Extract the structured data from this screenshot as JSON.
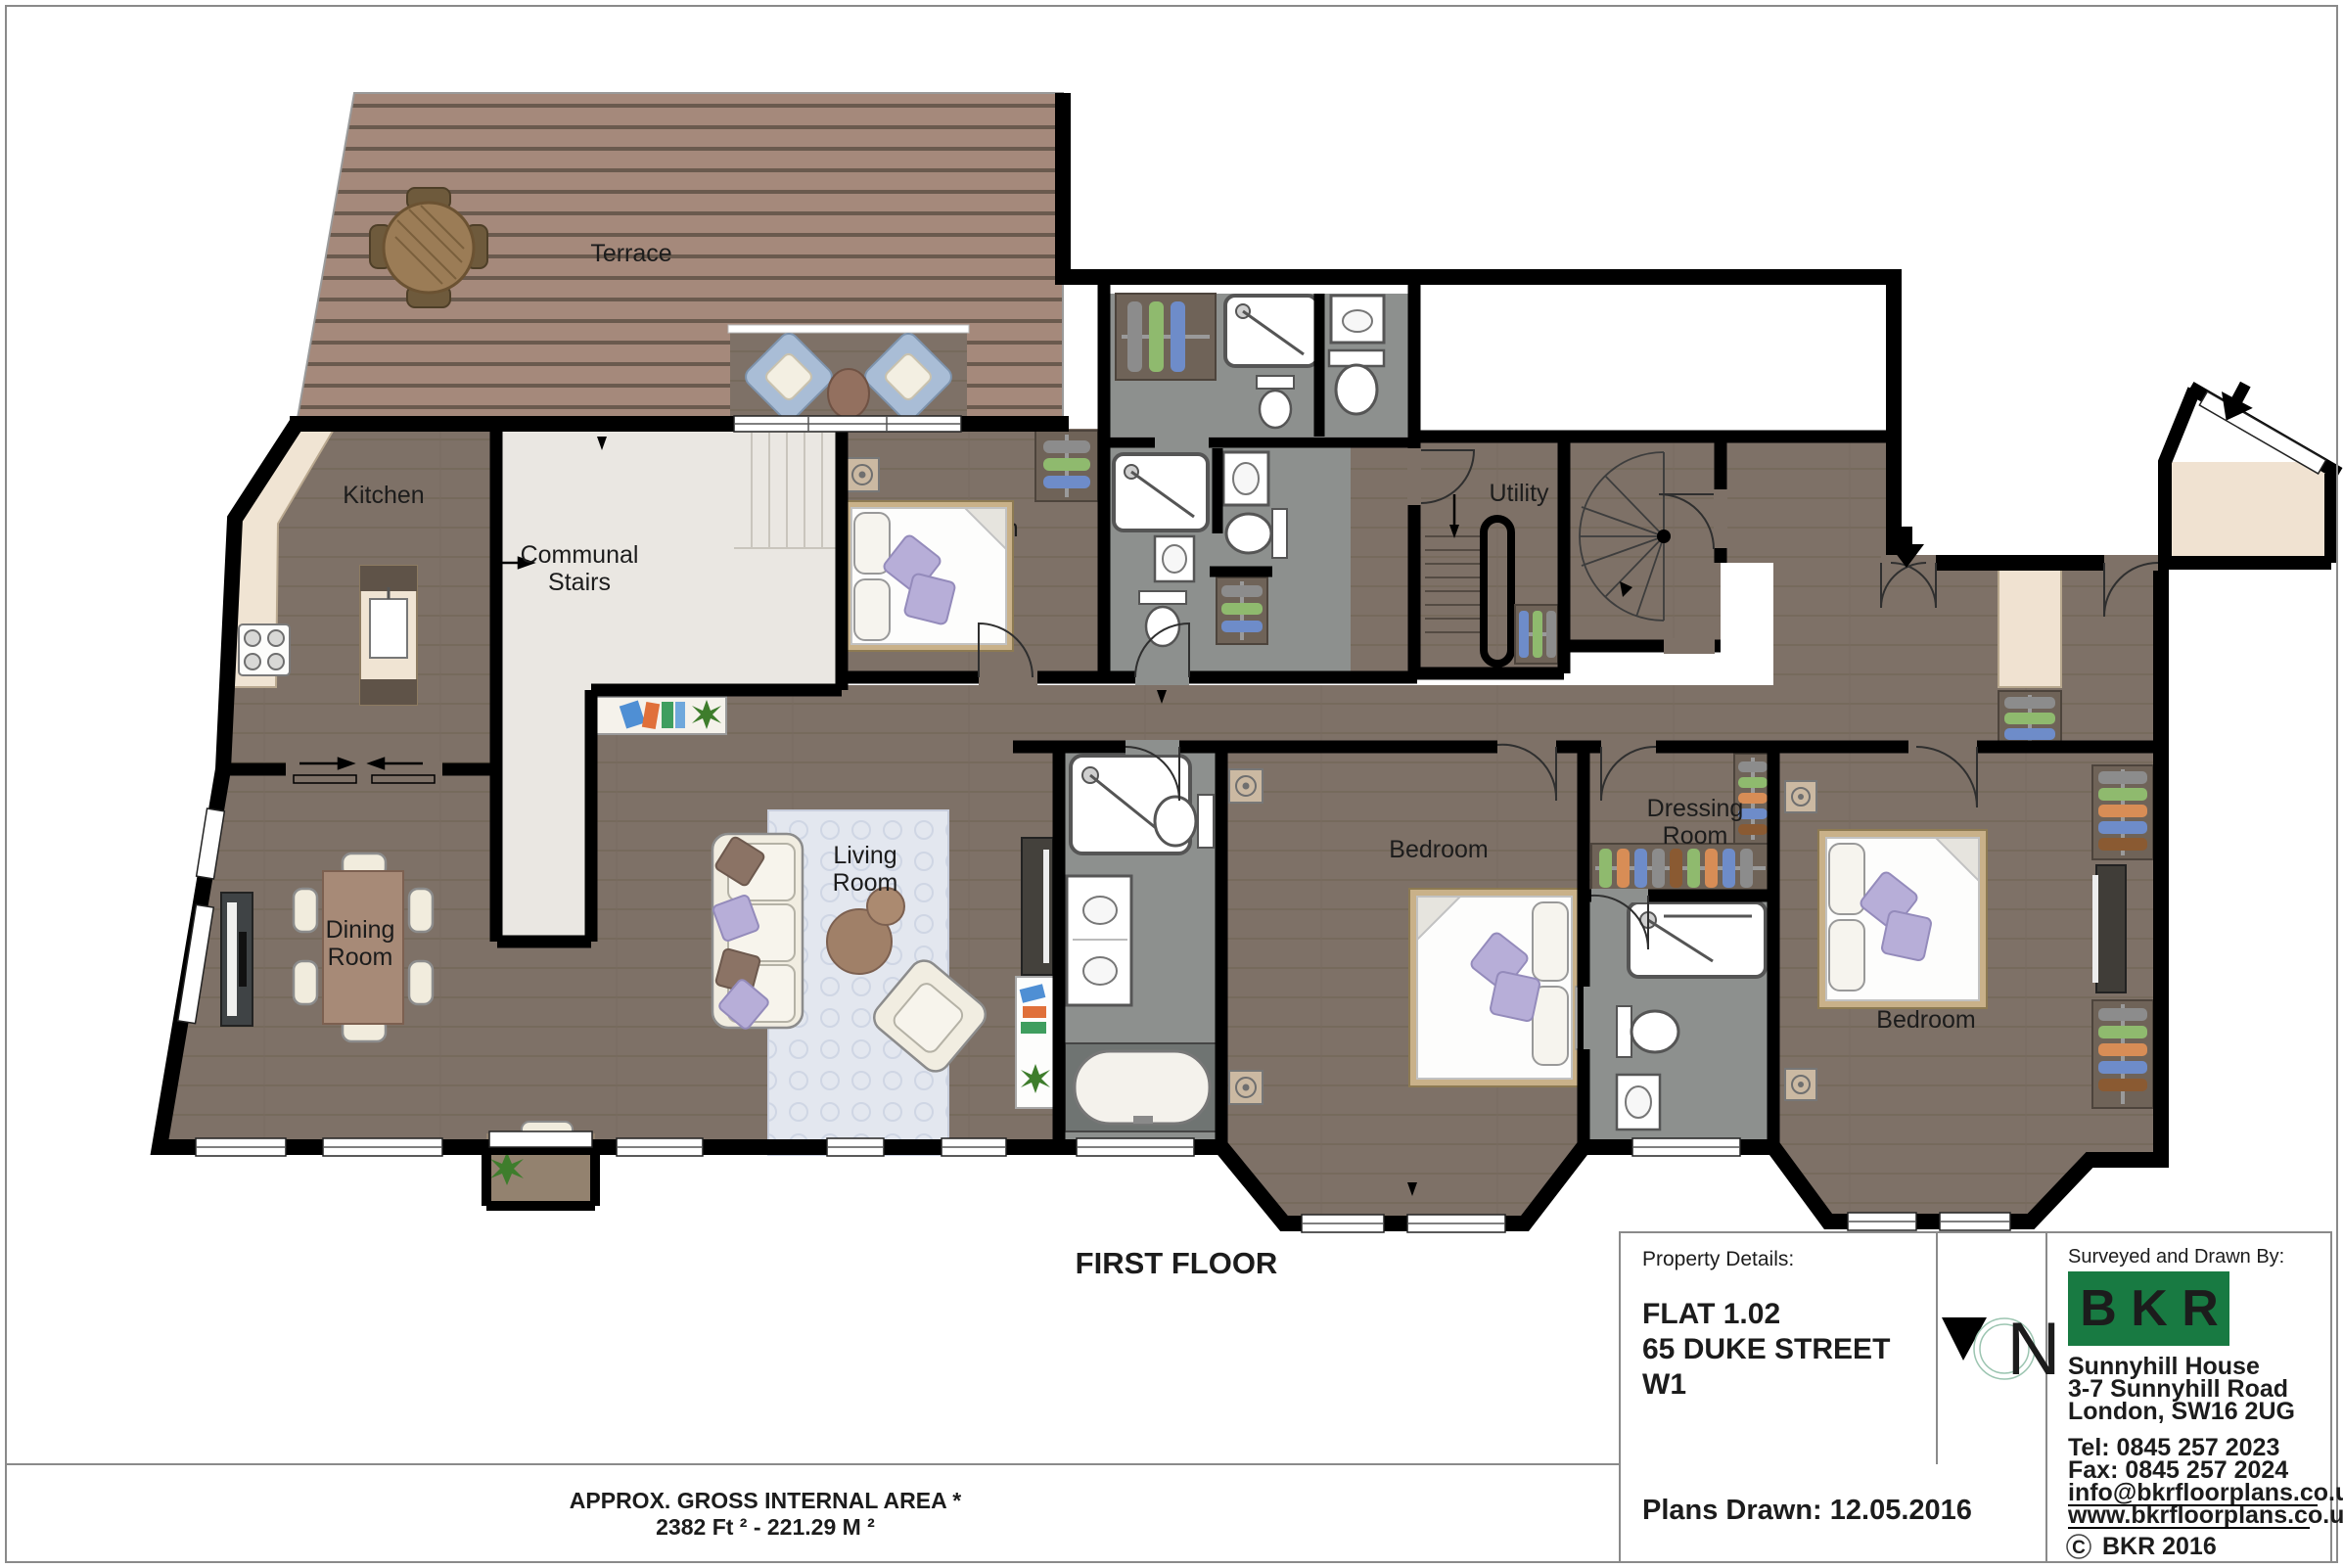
{
  "page": {
    "floor_title": "FIRST FLOOR",
    "area_note_line1": "APPROX. GROSS INTERNAL  AREA *",
    "area_note_line2": "2382 Ft ²  -  221.29 M ²"
  },
  "rooms": {
    "terrace": "Terrace",
    "kitchen": "Kitchen",
    "communal_stairs_1": "Communal",
    "communal_stairs_2": "Stairs",
    "utility": "Utility",
    "dining_1": "Dining",
    "dining_2": "Room",
    "living_1": "Living",
    "living_2": "Room",
    "bedroom_top": "Bedroom",
    "bedroom_center": "Bedroom",
    "bedroom_right": "Bedroom",
    "dressing_1": "Dressing",
    "dressing_2": "Room"
  },
  "title_block": {
    "property_details_label": "Property Details:",
    "flat": "FLAT 1.02",
    "street": "65 DUKE STREET",
    "postcode": "W1",
    "plans_drawn": "Plans Drawn: 12.05.2016",
    "north_letter": "N",
    "surveyed_label": "Surveyed and Drawn By:",
    "logo_text": "B K R",
    "company_address_1": "Sunnyhill House",
    "company_address_2": "3-7 Sunnyhill Road",
    "company_address_3": "London, SW16 2UG",
    "tel": "Tel:  0845 257 2023",
    "fax": "Fax: 0845 257 2024",
    "email": "info@bkrfloorplans.co.uk",
    "website": "www.bkrfloorplans.co.uk",
    "copyright_symbol": "C",
    "copyright_text": "BKR 2016"
  },
  "colors": {
    "logo_green": "#187a42",
    "wall_black": "#000000",
    "wood_floor": "#7e7167",
    "deck_wood": "#a5897b",
    "marble_white": "#eae7e2",
    "stone_grey": "#8d908e",
    "counter_cream": "#f0e4d3",
    "rug_blue": "#e3e7ef",
    "pillow_lavender": "#b7aed8",
    "chair_blue": "#a9bdd6"
  }
}
